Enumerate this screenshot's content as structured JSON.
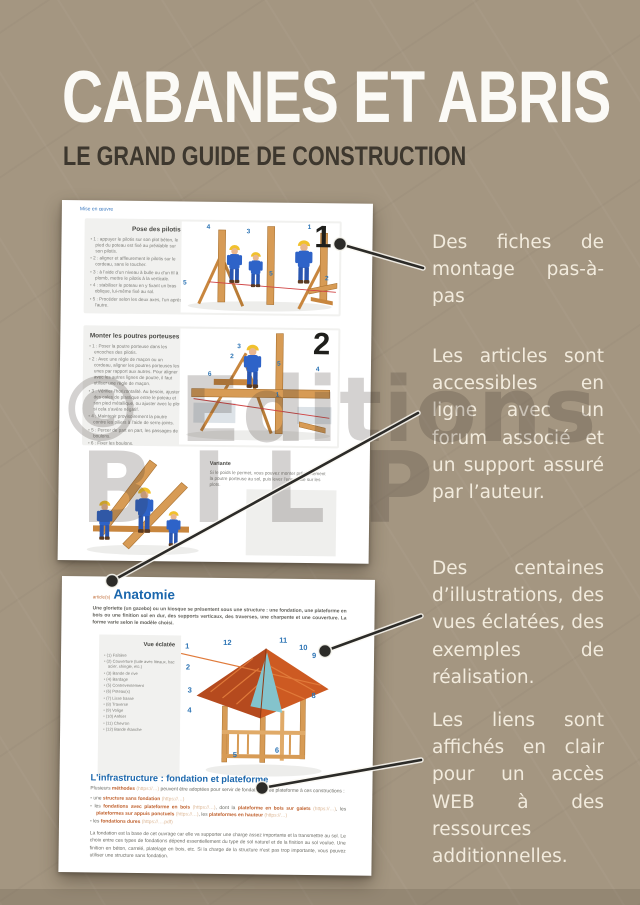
{
  "page": {
    "title": "CABANES ET ABRIS",
    "subtitle": "LE GRAND GUIDE DE CONSTRUCTION",
    "background_color": "#a49681",
    "accent_text_color": "#f2ebdd",
    "watermark": {
      "line1": "© Editions",
      "line2": "BILP"
    }
  },
  "callouts": [
    {
      "text": "Des fiches de montage pas-à-pas"
    },
    {
      "text": "Les articles sont accessibles en ligne avec un forum associé et un support assuré par l’auteur."
    },
    {
      "text": "Des centaines d’illustrations, des vues éclatées, des exemples de réalisation."
    },
    {
      "text": "Les liens sont affichés en clair pour un accès WEB à des ressources additionnelles."
    }
  ],
  "panel1": {
    "top_link": "Mise en œuvre",
    "sections": [
      {
        "heading": "Pose des pilotis",
        "figure_number": "1",
        "figure_labels": [
          "4",
          "3",
          "1",
          "5",
          "2",
          "5"
        ],
        "steps": [
          "1 : appuyer le pilotis sur son plot béton, le pied du poteau est fixé au préalable sur son pilotis.",
          "2 : aligner et affleurement le pilotis sur le cordeau, sans le toucher.",
          "3 : à l’aide d’un niveau à bulle ou d’un fil à plomb, mettre le pilotis à la verticale.",
          "4 : stabiliser le poteau en y fixant un bras oblique, lui-même fixé au sol.",
          "5 : Procéder selon les deux axes, l’un après l’autre."
        ]
      },
      {
        "heading": "Monter les poutres porteuses",
        "figure_number": "2",
        "figure_labels": [
          "3",
          "2",
          "5",
          "4",
          "6",
          "1"
        ],
        "steps": [
          "1 : Poser la poutre porteuse dans les encoches des pilotis.",
          "2 : Avec une règle de maçon ou un cordeau, aligner les poutres porteuses les unes par rapport aux autres. Pour aligner avec les autres lignes de poutre, il faut utiliser une règle de maçon.",
          "3 : Vérifier l’horizontalité. Au besoin, ajuster des cales de plastique entre le poteau et son pied métallique, ou ajuster avec le plot si cela s’avère négatif.",
          "4 : Maintenir provisoirement la poutre contre les piliers à l’aide de serre-joints.",
          "5 : Percer de part en part, les passages de boulons.",
          "6 : Fixer les boulons."
        ]
      }
    ],
    "variante": {
      "heading": "Variante",
      "text": "Si le poids le permet, vous pouvez monter préalablement la poutre porteuse au sol, puis lever l’ensemble sur les plots."
    }
  },
  "panel2": {
    "article_tag": "article(s)",
    "heading": "Anatomie",
    "intro": "Une gloriette (un gazebo) ou un kiosque se présentent sous une structure : une fondation, une plateforme en bois ou une finition sol en dur, des supports verticaux, des traverses, une charpente et une couverture. La forme varie selon le modèle choisi.",
    "exploded": {
      "heading": "Vue éclatée",
      "items": [
        "(1) Faîtière",
        "(2) Couverture (tuile avec liteaux, bac acier, shingle, etc.)",
        "(3) Bande de rive",
        "(4) Bardage",
        "(5) Contreventement",
        "(6) Poteau(x)",
        "(7) Lisse basse",
        "(8) Traverse",
        "(9) Volige",
        "(10) Arêtier",
        "(11) Chevron",
        "(12) Bande étanche"
      ],
      "figure_numbers": [
        "1",
        "2",
        "3",
        "4",
        "12",
        "11",
        "10",
        "9",
        "8",
        "5",
        "6"
      ]
    },
    "infrastructure": {
      "heading": "L'infrastructure : fondation et plateforme",
      "intro_segments": [
        {
          "t": "Plusieurs ",
          "c": "body"
        },
        {
          "t": "méthodes",
          "c": "link"
        },
        {
          "t": " (https://…) ",
          "c": "url"
        },
        {
          "t": "peuvent être adoptées pour servir de fondation et de plateforme à ces constructions :",
          "c": "body"
        }
      ],
      "bullets": [
        [
          {
            "t": "une ",
            "c": "body"
          },
          {
            "t": "structure sans fondation",
            "c": "link"
          },
          {
            "t": " (https://…)",
            "c": "url"
          }
        ],
        [
          {
            "t": "les ",
            "c": "body"
          },
          {
            "t": "fondations avec plateforme en bois",
            "c": "link"
          },
          {
            "t": " (https://…)",
            "c": "url"
          },
          {
            "t": ", dont la ",
            "c": "body"
          },
          {
            "t": "plateforme en bois sur galets",
            "c": "link"
          },
          {
            "t": " (https://…)",
            "c": "url"
          },
          {
            "t": ", les ",
            "c": "body"
          },
          {
            "t": "plateformes sur appuis ponctuels",
            "c": "link"
          },
          {
            "t": " (https://…)",
            "c": "url"
          },
          {
            "t": ", les ",
            "c": "body"
          },
          {
            "t": "plateformes en hauteur",
            "c": "link"
          },
          {
            "t": " (https://…)",
            "c": "url"
          }
        ],
        [
          {
            "t": "les ",
            "c": "body"
          },
          {
            "t": "fondations dures",
            "c": "link"
          },
          {
            "t": " (https://….pdf)",
            "c": "url"
          }
        ]
      ],
      "footer": "La fondation est la base de cet ouvrage car elle va supporter une charge assez importante et la transmettre au sol. Le choix entre ces types de fondations dépend essentiellement du type de sol naturel et de la finition au sol voulue. Une finition en béton, carrelé, platelage en bois, etc. Si la charge de la structure n'est pas trop importante, vous pouvez utiliser une structure sans fondation."
    }
  }
}
